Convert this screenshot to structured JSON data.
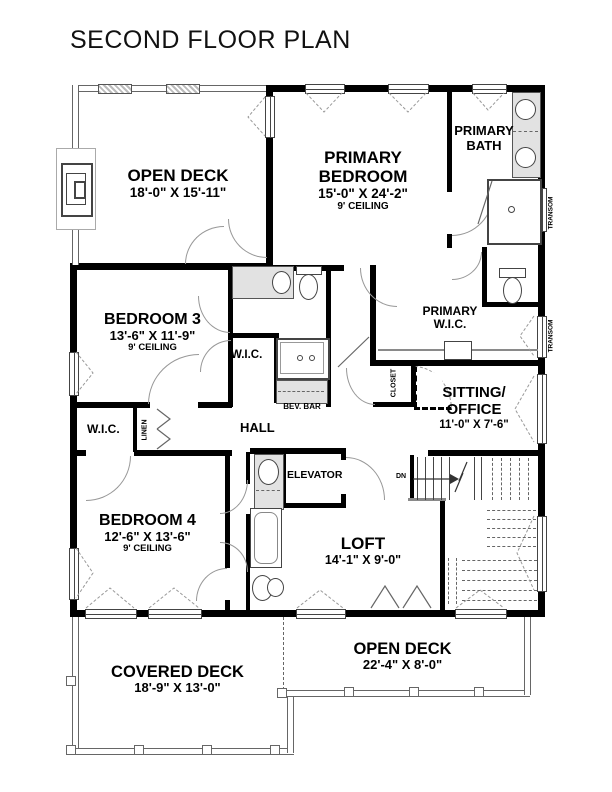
{
  "title": "SECOND FLOOR PLAN",
  "rooms": {
    "open_deck_upper": {
      "line1": "OPEN DECK",
      "dims": "18'-0\" X 15'-11\""
    },
    "primary_bedroom": {
      "line1": "PRIMARY",
      "line2": "BEDROOM",
      "dims": "15'-0\" X 24'-2\"",
      "ceiling": "9' CEILING"
    },
    "primary_bath": {
      "line1": "PRIMARY",
      "line2": "BATH"
    },
    "bedroom_3": {
      "line1": "BEDROOM 3",
      "dims": "13'-6\" X 11'-9\"",
      "ceiling": "9' CEILING"
    },
    "primary_wic": {
      "line1": "PRIMARY",
      "line2": "W.I.C."
    },
    "sitting_office": {
      "line1": "SITTING/",
      "line2": "OFFICE",
      "dims": "11'-0\" X 7'-6\""
    },
    "bedroom_4": {
      "line1": "BEDROOM 4",
      "dims": "12'-6\" X 13'-6\"",
      "ceiling": "9' CEILING"
    },
    "loft": {
      "line1": "LOFT",
      "dims": "14'-1\" X 9'-0\""
    },
    "covered_deck": {
      "line1": "COVERED DECK",
      "dims": "18'-9\" X 13'-0\""
    },
    "open_deck_lower": {
      "line1": "OPEN DECK",
      "dims": "22'-4\" X 8'-0\""
    }
  },
  "labels": {
    "hall": "HALL",
    "elevator": "ELEVATOR",
    "bev_bar": "BEV. BAR",
    "wic_hall_bath": "W.I.C.",
    "wic_bedroom4": "W.I.C.",
    "closet": "CLOSET",
    "linen": "LINEN",
    "transom_upper": "TRANSOM",
    "transom_lower": "TRANSOM",
    "down": "DN"
  },
  "colors": {
    "wall": "#000000",
    "fixture": "#e2e2e2",
    "line": "#555555"
  }
}
